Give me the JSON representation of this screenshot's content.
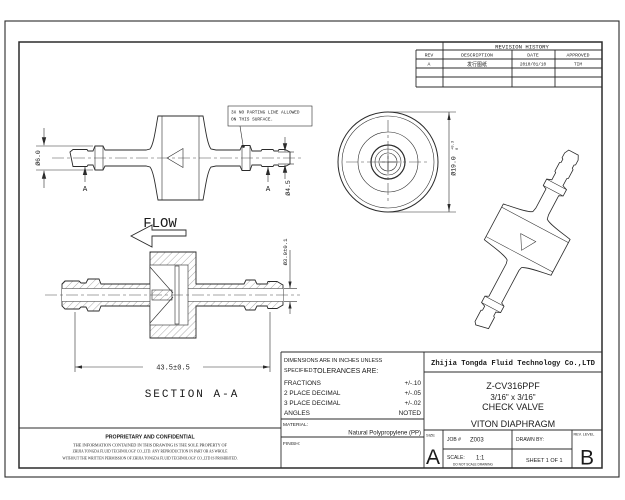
{
  "revision": {
    "title": "REVISION HISTORY",
    "headers": {
      "rev": "REV",
      "description": "DESCRIPTION",
      "date": "DATE",
      "approved": "APPROVED"
    },
    "rows": [
      {
        "rev": "A",
        "description": "发行图纸",
        "date": "2010/01/10",
        "approved": "TIM"
      }
    ]
  },
  "notes": {
    "parting_line1": "3X NO PARTING LINE ALLOWED",
    "parting_line2": "ON THIS SURFACE.",
    "flow": "FLOW",
    "section_label": "SECTION A-A"
  },
  "dims": {
    "d6": "Ø6.0",
    "d45": "Ø4.5",
    "d19": "Ø19.0",
    "d19_tol_upper": "+0.3",
    "d19_tol_lower": "0",
    "d3": "Ø3.0±0.1",
    "length": "43.5±0.5",
    "datum": "A"
  },
  "tolerances": {
    "header_line1": "DIMENSIONS ARE IN INCHES UNLESS",
    "header_line2a": "SPECIFIED.",
    "header_line2b": "TOLERANCES ARE:",
    "rows": [
      {
        "label": "FRACTIONS",
        "value": "+/-.10"
      },
      {
        "label": "2 PLACE DECIMAL",
        "value": "+/-.05"
      },
      {
        "label": "3 PLACE DECIMAL",
        "value": "+/-.02"
      },
      {
        "label": "ANGLES",
        "value": "NOTED"
      }
    ],
    "material_label": "MATERIAL:",
    "material_value": "Natural Polypropylene (PP)",
    "finish_label": "FINISH:"
  },
  "title_block": {
    "company": "Zhijia Tongda Fluid Technology Co.,LTD",
    "part_number": "Z-CV316PPF",
    "size_desc": "3/16\" x 3/16\"",
    "product": "CHECK VALVE",
    "diaphragm": "VITON DIAPHRAGM",
    "size_label": "SIZE",
    "size_value": "A",
    "job_label": "JOB #",
    "job_value": "Z003",
    "drawn_label": "DRAWN BY:",
    "scale_label": "SCALE:",
    "scale_value": "1:1",
    "scale_note": "DO NOT SCALE DRAWING",
    "sheet_label": "SHEET 1 OF 1",
    "rev_label": "REV. LEVEL",
    "rev_value": "B"
  },
  "proprietary": {
    "title": "PROPRIETARY AND CONFIDENTIAL",
    "line1": "THE INFORMATION CONTAINED IN THIS DRAWING IS THE SOLE PROPERTY OF",
    "line2": "ZHIJIA TONGDA FLUID TECHNOLOGY CO.,LTD. ANY REPRODUCTION IN PART OR AS WHOLE",
    "line3": "WITHOUT THE WRITTEN PERMISSION OF  ZHIJIA TONGDA FLUID TECHNOLOGY CO.,LTD IS PROHIBITED."
  }
}
